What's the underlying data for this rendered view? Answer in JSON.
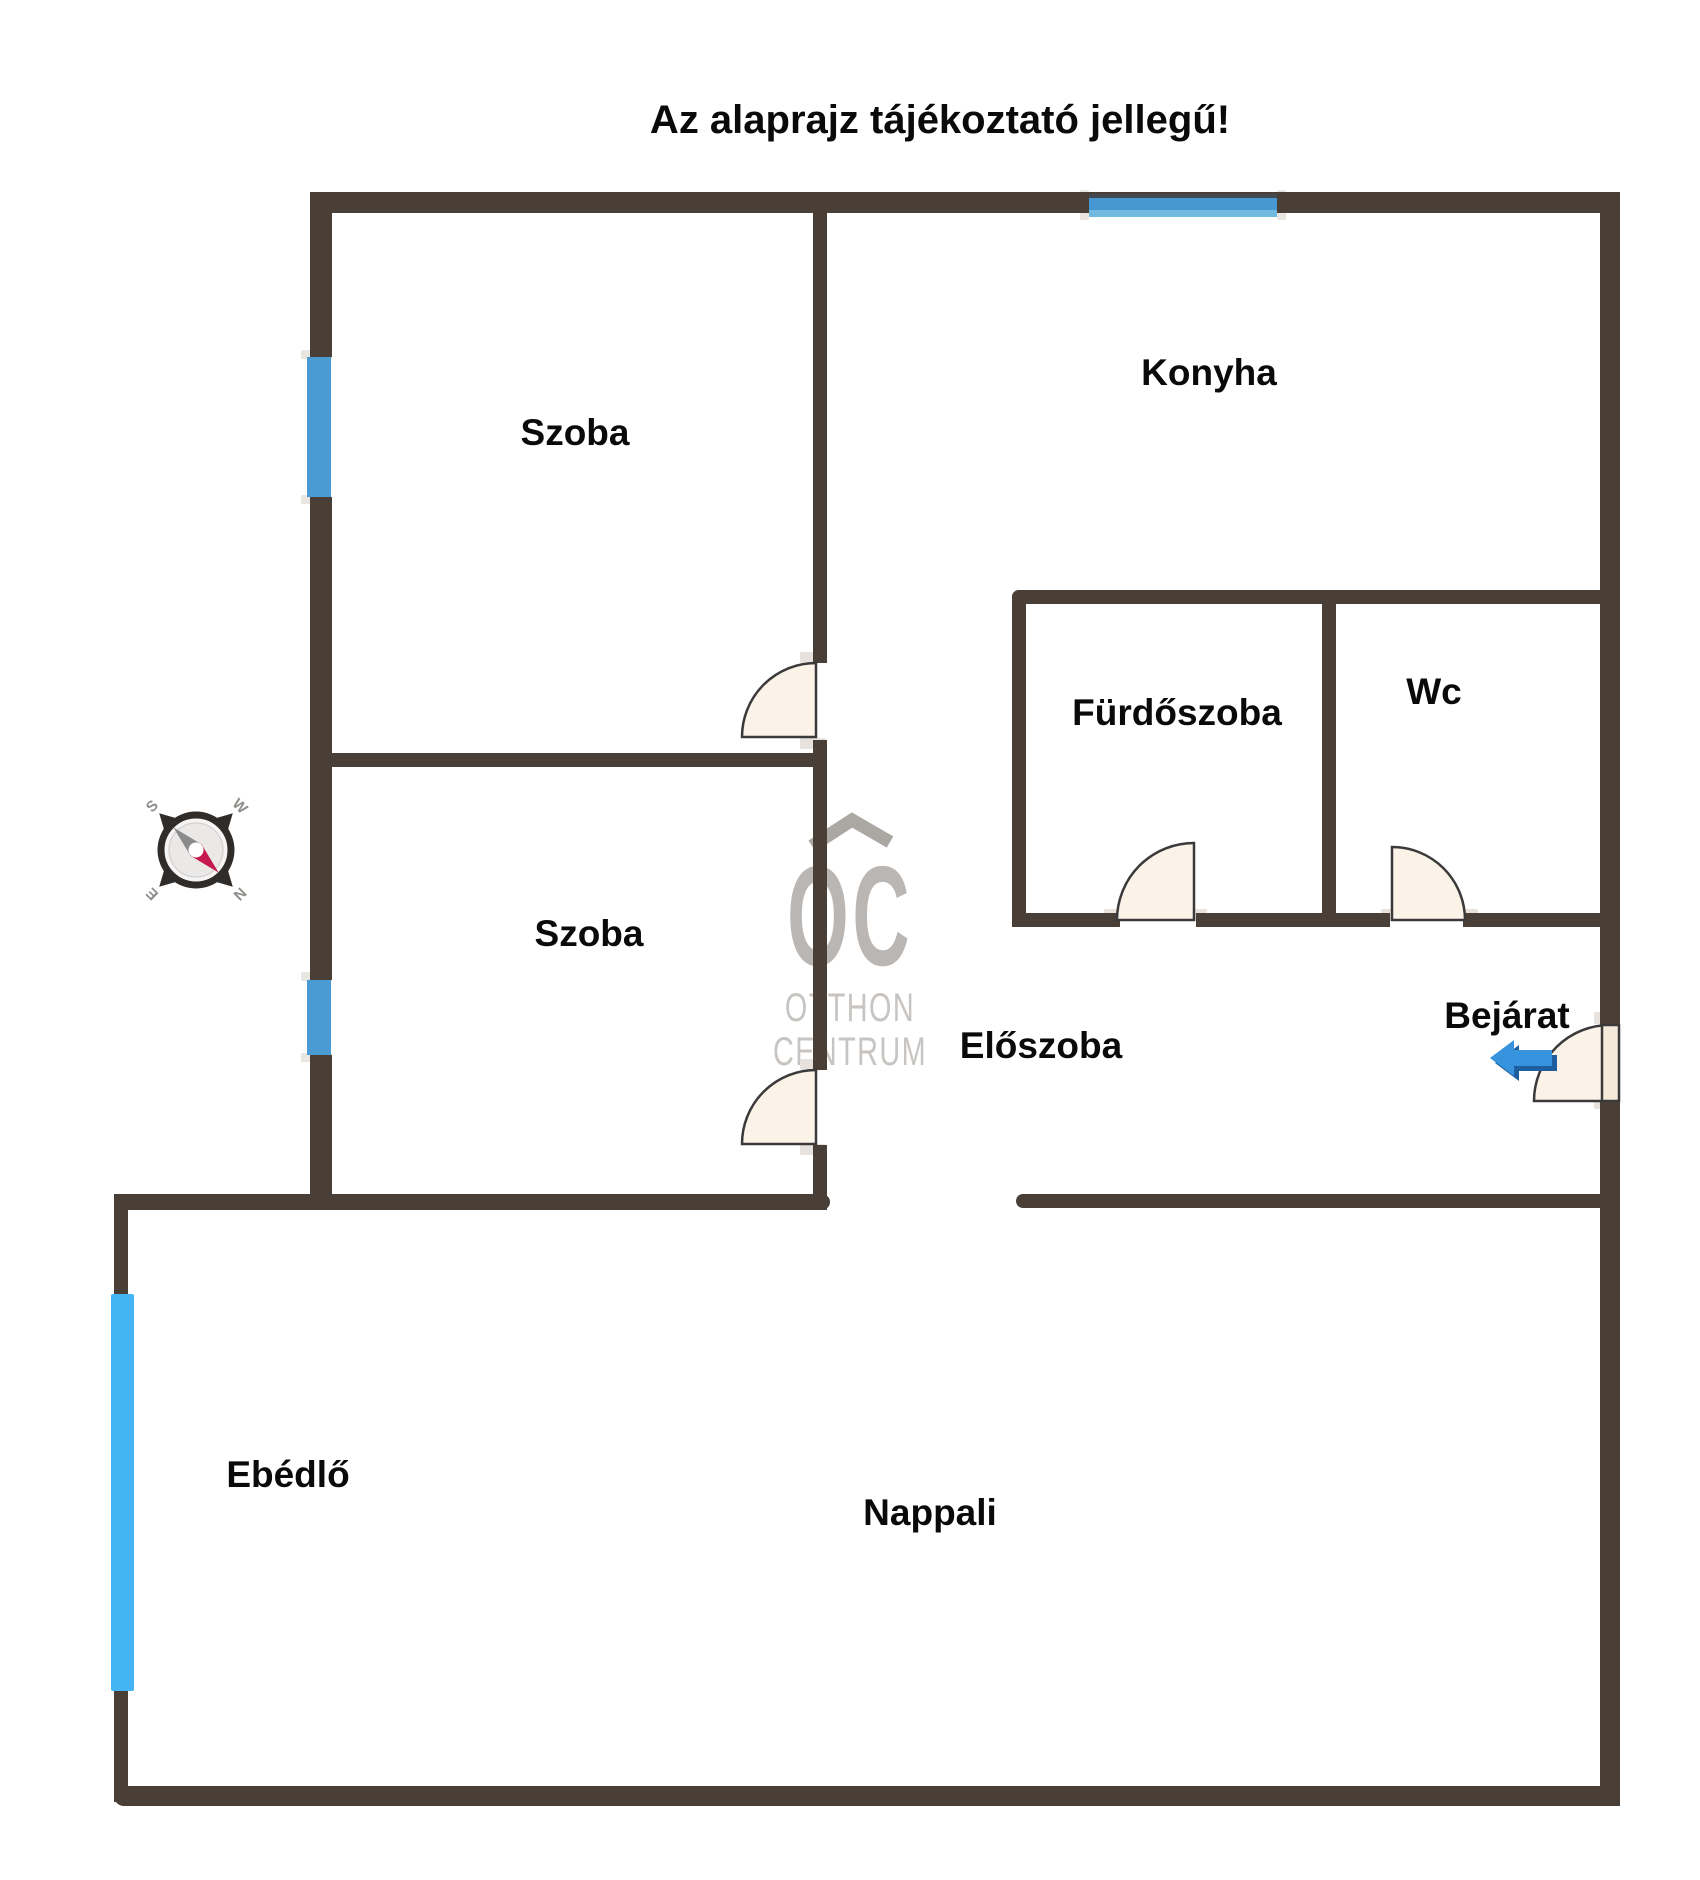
{
  "title": "Az alaprajz tájékoztató jellegű!",
  "rooms": [
    {
      "name": "szoba-felso",
      "label": "Szoba"
    },
    {
      "name": "konyha",
      "label": "Konyha"
    },
    {
      "name": "furdoszoba",
      "label": "Fürdőszoba"
    },
    {
      "name": "wc",
      "label": "Wc"
    },
    {
      "name": "szoba-also",
      "label": "Szoba"
    },
    {
      "name": "eloszoba",
      "label": "Előszoba"
    },
    {
      "name": "bejarat",
      "label": "Bejárat"
    },
    {
      "name": "ebedlo",
      "label": "Ebédlő"
    },
    {
      "name": "nappali",
      "label": "Nappali"
    }
  ],
  "watermark": {
    "logo": "OC",
    "line1": "OTTHON",
    "line2": "CENTRUM"
  },
  "compass": {
    "top_left": "S",
    "top_right": "W",
    "bottom_left": "E",
    "bottom_right": "N"
  },
  "colors": {
    "wall": "#4a3f36",
    "window_blue": "#4598d2",
    "window_bright_blue": "#45b4f4",
    "door_fill": "#fcf3e8",
    "door_stroke": "#3a3a3a",
    "arrow_blue": "#3793dd",
    "arrow_blue_dark": "#1d5f9e",
    "watermark_gray": "#bab6b3",
    "needle_red": "#c51a4f",
    "needle_gray": "#8b8b8b"
  }
}
